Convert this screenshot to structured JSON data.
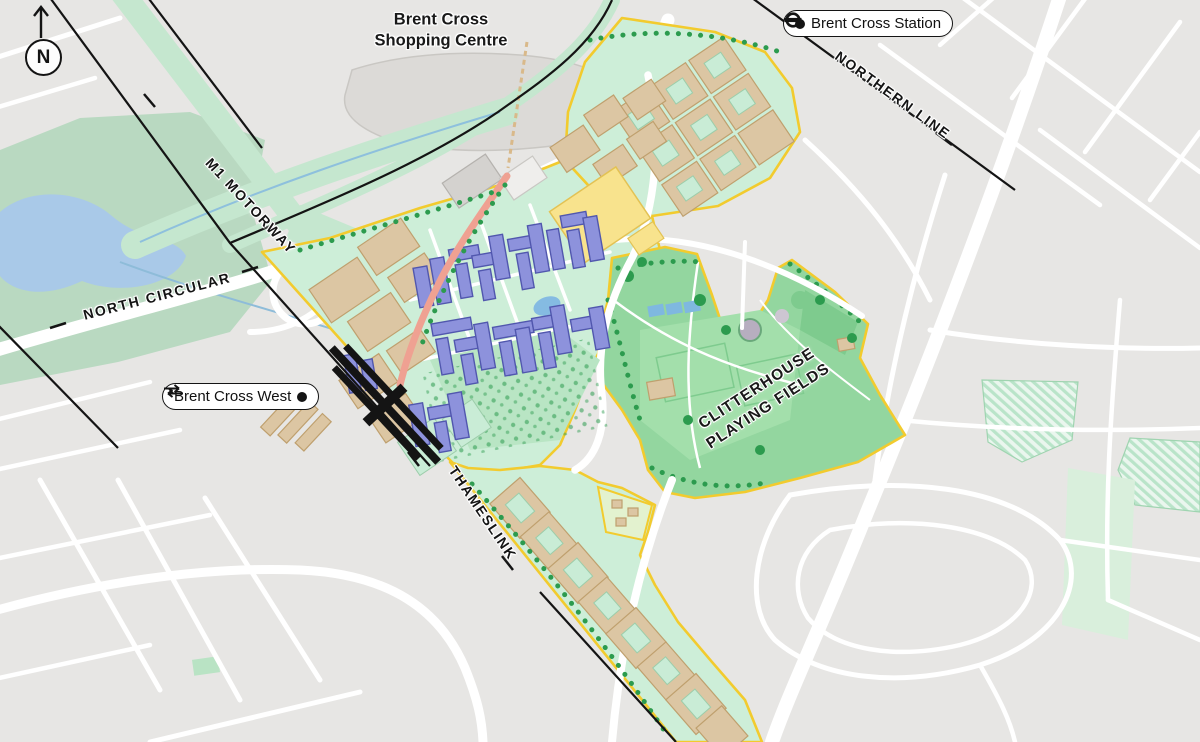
{
  "compass": {
    "letter": "N"
  },
  "area_labels": {
    "shopping_centre": {
      "line1": "Brent Cross",
      "line2": "Shopping Centre"
    },
    "playing_fields": {
      "line1": "CLITTERHOUSE",
      "line2": "PLAYING FIELDS"
    }
  },
  "transport_labels": {
    "m1": "M1 MOTORWAY",
    "north_circular": "NORTH CIRCULAR",
    "northern_line": "NORTHERN LINE",
    "thameslink": "THAMESLINK"
  },
  "stations": {
    "brent_cross": {
      "label": "Brent Cross Station",
      "icon": "underground-roundel"
    },
    "brent_cross_west": {
      "label": "Brent Cross West",
      "icon": "national-rail"
    }
  },
  "colors": {
    "background": "#e7e6e4",
    "road_white": "#ffffff",
    "site_boundary_yellow": "#f2cb2e",
    "mint_green": "#cdeed8",
    "field_green": "#93d69f",
    "tree_green": "#2c9b4e",
    "building_tan": "#dcc6a3",
    "residential_purple": "#8d92dc",
    "feature_yellow": "#f8e38d",
    "high_street_salmon": "#efa192",
    "park_sage": "#b9d9c1",
    "lake_blue": "#a9c9e8",
    "rail_black": "#141414"
  }
}
